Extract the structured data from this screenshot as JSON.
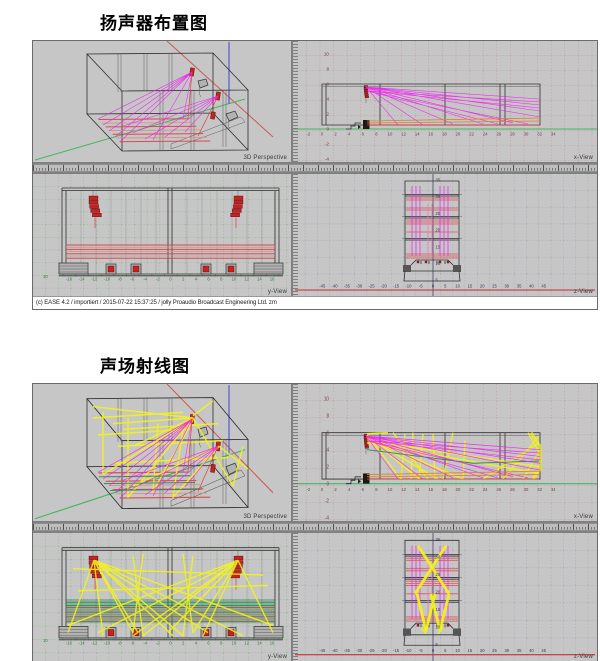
{
  "colors": {
    "paneBg": "#c6c6c6",
    "figDivider": "#808080",
    "gridRed": "#b46a6a",
    "gridGreen": "#55a055",
    "gridBlue": "#7880b0",
    "outline": "#303030",
    "rayMagenta": "#f020f0",
    "rayRed": "#e04040",
    "rayOrange": "#e08030",
    "rayYellow": "#f4f414",
    "greenRay": "#2e8b57",
    "axisGreen": "#40b860",
    "axisRed": "#d05858",
    "axisBlue": "#5858d0",
    "speakerRed": "#cc2020",
    "audienceRed": "#d05050",
    "tickRed": "#7a3a3a",
    "tickGreen": "#2f7d2f",
    "zAxisRed": "#cc3333",
    "statusBg": "#ffffff"
  },
  "figure1": {
    "title": "扬声器布置图",
    "status": "(c) EASE 4.2  / importiert  / 2015-07-22 15:37:25 / jolly Proaudio Broadcast Engineering Ltd. zm",
    "panes": {
      "perspective": {
        "label": "3D Perspective"
      },
      "x_view": {
        "label": "x-View",
        "y_ticks": [
          10,
          8,
          6,
          4,
          2,
          0,
          -2,
          -4
        ],
        "x_ticks": [
          -2,
          0,
          2,
          4,
          6,
          8,
          10,
          12,
          14,
          16,
          18,
          20,
          22,
          24,
          26,
          28,
          30,
          32,
          34
        ]
      },
      "y_view": {
        "label": "y-View",
        "origin_label": "10",
        "x_ticks": [
          -16,
          -14,
          -12,
          -10,
          -8,
          -6,
          -4,
          -2,
          0,
          2,
          4,
          6,
          8,
          10,
          12,
          14,
          16
        ]
      },
      "z_view": {
        "label": "z-View",
        "y_ticks": [
          35,
          30,
          25,
          20,
          15,
          10,
          5
        ],
        "x_ticks": [
          -45,
          -40,
          -35,
          -30,
          -25,
          -20,
          -15,
          -10,
          -5,
          0,
          5,
          10,
          15,
          20,
          25,
          30,
          35,
          40,
          45
        ]
      }
    }
  },
  "figure2": {
    "title": "声场射线图",
    "status": "(c) EASE 4.2  / importiert  / 2015-07-22 15:36:57 / jolly Proaudio Broadcast Engineering Ltd. zm",
    "panes": {
      "perspective": {
        "label": "3D Perspective"
      },
      "x_view": {
        "label": "x-View",
        "y_ticks": [
          10,
          8,
          6,
          4,
          2,
          0,
          -2,
          -4
        ],
        "x_ticks": [
          -2,
          0,
          2,
          4,
          6,
          8,
          10,
          12,
          14,
          16,
          18,
          20,
          22,
          24,
          26,
          28,
          30,
          32,
          34
        ]
      },
      "y_view": {
        "label": "y-View",
        "origin_label": "10",
        "x_ticks": [
          -16,
          -14,
          -12,
          -10,
          -8,
          -6,
          -4,
          -2,
          0,
          2,
          4,
          6,
          8,
          10,
          12,
          14,
          16
        ]
      },
      "z_view": {
        "label": "z-View",
        "y_ticks": [
          35,
          30,
          25,
          20,
          15,
          10,
          5
        ],
        "x_ticks": [
          -45,
          -40,
          -35,
          -30,
          -25,
          -20,
          -15,
          -10,
          -5,
          0,
          5,
          10,
          15,
          20,
          25,
          30,
          35,
          40,
          45
        ]
      }
    }
  }
}
